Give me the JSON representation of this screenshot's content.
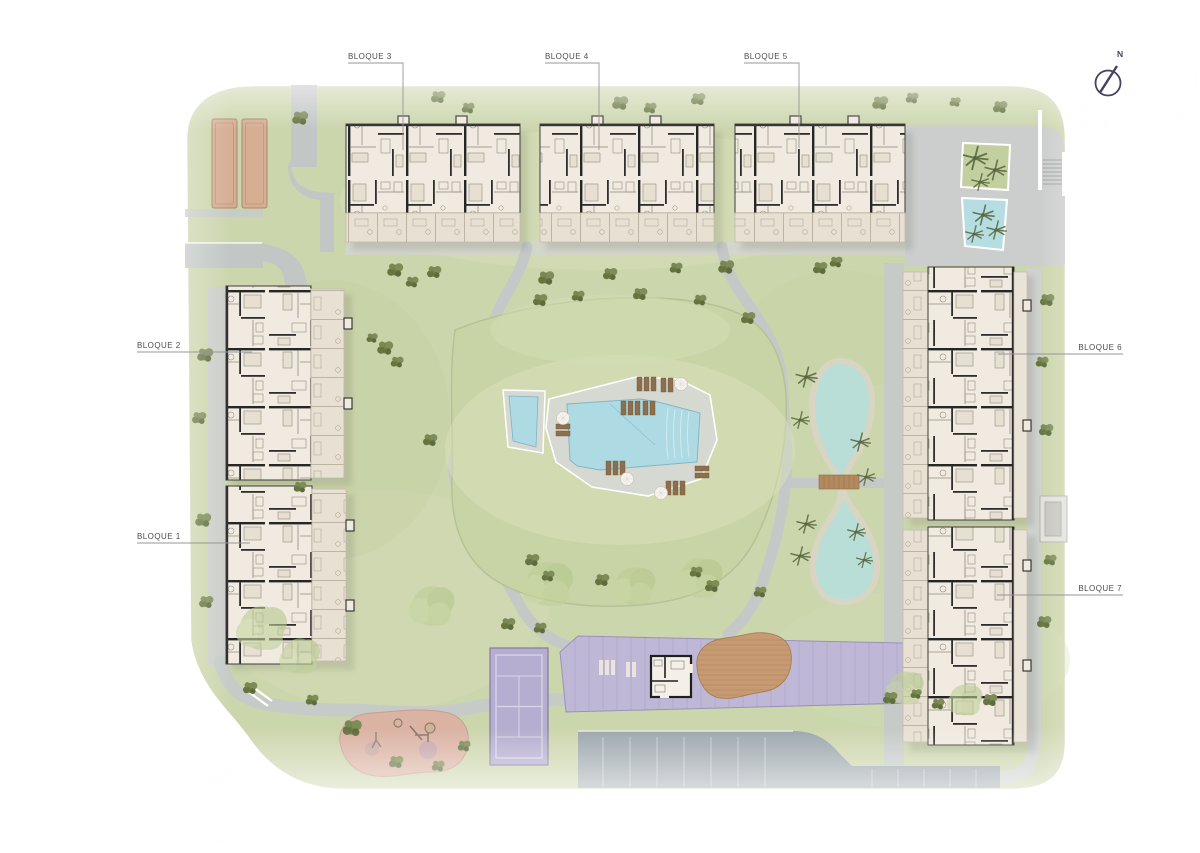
{
  "site_plan": {
    "blocks": [
      {
        "id": 1,
        "label": "BLOQUE 1"
      },
      {
        "id": 2,
        "label": "BLOQUE 2"
      },
      {
        "id": 3,
        "label": "BLOQUE 3"
      },
      {
        "id": 4,
        "label": "BLOQUE 4"
      },
      {
        "id": 5,
        "label": "BLOQUE 5"
      },
      {
        "id": 6,
        "label": "BLOQUE 6"
      },
      {
        "id": 7,
        "label": "BLOQUE 7"
      }
    ],
    "compass": {
      "north_label": "N"
    },
    "amenities": [
      "main-pool",
      "kids-pool",
      "ornamental-pond",
      "pond-bridge",
      "padel-court",
      "community-deck",
      "clubhouse",
      "wood-deck",
      "playground",
      "petanque-courts",
      "parking",
      "planter-pool",
      "stairs"
    ],
    "colors": {
      "grass": "#ccd6ad",
      "path": "#c4c9c7",
      "parking": "#9da7ad",
      "pool_water": "#aedae3",
      "pond_water": "#b9ded7",
      "court_purple": "#b5aed0",
      "deck_purple": "#beb7d6",
      "playground_pink": "#dbb3a3",
      "building_cream": "#f0eae0",
      "wood": "#c79a72",
      "label_text": "#4c4c4c",
      "compass": "#474060"
    }
  }
}
